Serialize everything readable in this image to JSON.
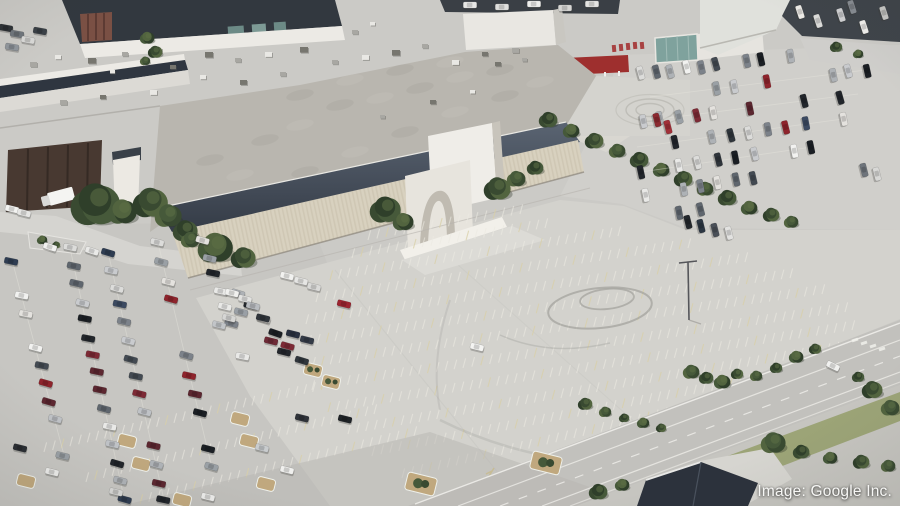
{
  "caption": {
    "text": "Image: Google Inc."
  },
  "palette": {
    "base": "#cbcac6",
    "lot": "#d3d2cd",
    "parkingLeft": "#c7c6c2",
    "parkingRight": "#d0cfcb",
    "road": "#c2c1bd",
    "roadShade": "#b7b6b2",
    "verge": "#c6c5c0",
    "roofLight": "#c6c4bf",
    "roofGravel": "#b9b6af",
    "roofDark1": "#5a6472",
    "roofDark2": "#343b46",
    "roofNavy": "#32383f",
    "facade": "#d8d1bf",
    "white": "#eceae5",
    "brick": "#7a5044",
    "dock": "#483931",
    "teal": "#7fa29d",
    "redCanopy": "#9e2f2e",
    "grass": "#97a06f",
    "mulch": "#c0a87e",
    "treeDark": "#394a31",
    "treeMid": "#46593a",
    "treeLight": "#5d7045",
    "stripe": "#eceae2",
    "stripeYellow": "#d9d0a8",
    "navyRoofBldg": "#2c323c"
  },
  "scene": {
    "car_colors": [
      "#e9e9e7",
      "#f2f2f0",
      "#dcdcda",
      "#c9cbce",
      "#aeb2b6",
      "#9aa0a5",
      "#7c828a",
      "#5f666e",
      "#434a52",
      "#2f353b",
      "#22262b",
      "#1b1f24",
      "#8e242c",
      "#7d2a35",
      "#5c2730",
      "#3c4a61",
      "#2f3d52",
      "#d9d7d2",
      "#bfc2c6",
      "#e4e2de"
    ],
    "left_rows": [
      {
        "x1": 12,
        "y1": 260,
        "x2": 64,
        "y2": 455,
        "n": 12,
        "d": 0.82,
        "rot": 14,
        "line": true
      },
      {
        "x1": 70,
        "y1": 248,
        "x2": 124,
        "y2": 498,
        "n": 15,
        "d": 0.9,
        "rot": 14,
        "line": true
      },
      {
        "x1": 108,
        "y1": 252,
        "x2": 164,
        "y2": 500,
        "n": 15,
        "d": 0.88,
        "rot": 14,
        "line": true
      },
      {
        "x1": 158,
        "y1": 243,
        "x2": 212,
        "y2": 468,
        "n": 13,
        "d": 0.78,
        "rot": 14,
        "line": true
      },
      {
        "x1": 203,
        "y1": 241,
        "x2": 242,
        "y2": 356,
        "n": 8,
        "d": 0.8,
        "rot": 14
      },
      {
        "x1": 237,
        "y1": 292,
        "x2": 302,
        "y2": 360,
        "n": 6,
        "d": 0.85,
        "rot": 16
      }
    ],
    "right_rows": [
      {
        "x1": 642,
        "y1": 74,
        "x2": 790,
        "y2": 55,
        "n": 11,
        "d": 0.85,
        "rot": 77
      },
      {
        "x1": 650,
        "y1": 97,
        "x2": 866,
        "y2": 70,
        "n": 14,
        "d": 0.62,
        "rot": 77,
        "line": true
      },
      {
        "x1": 643,
        "y1": 121,
        "x2": 858,
        "y2": 94,
        "n": 13,
        "d": 0.68,
        "rot": 77,
        "line": true
      },
      {
        "x1": 637,
        "y1": 147,
        "x2": 843,
        "y2": 119,
        "n": 12,
        "d": 0.66,
        "rot": 77,
        "line": true
      },
      {
        "x1": 641,
        "y1": 172,
        "x2": 812,
        "y2": 147,
        "n": 10,
        "d": 0.58,
        "rot": 77,
        "line": true
      },
      {
        "x1": 647,
        "y1": 196,
        "x2": 772,
        "y2": 174,
        "n": 8,
        "d": 0.6,
        "rot": 77
      },
      {
        "x1": 660,
        "y1": 215,
        "x2": 742,
        "y2": 202,
        "n": 5,
        "d": 0.5,
        "rot": 77
      }
    ],
    "extra_cars": [
      [
        6,
        28,
        10,
        "#2e3236"
      ],
      [
        17,
        34,
        10,
        "#70767c"
      ],
      [
        28,
        40,
        10,
        "#d9d9d7"
      ],
      [
        40,
        31,
        10,
        "#3a4046"
      ],
      [
        12,
        47,
        10,
        "#90969c"
      ],
      [
        800,
        12,
        72,
        "#eceae6"
      ],
      [
        818,
        21,
        72,
        "#dcdcda"
      ],
      [
        841,
        15,
        72,
        "#cfd0d2"
      ],
      [
        864,
        27,
        72,
        "#f0efec"
      ],
      [
        884,
        13,
        72,
        "#c7c7c5"
      ],
      [
        852,
        7,
        72,
        "#878c92"
      ],
      [
        470,
        5,
        0,
        "#e8e8e6"
      ],
      [
        502,
        7,
        0,
        "#dfdfdd"
      ],
      [
        534,
        4,
        0,
        "#eeeeec"
      ],
      [
        565,
        8,
        0,
        "#d6d6d4"
      ],
      [
        592,
        4,
        0,
        "#e4e4e2"
      ],
      [
        50,
        247,
        18,
        "#f1f1ef"
      ],
      [
        92,
        251,
        18,
        "#e9e9e7"
      ],
      [
        12,
        209,
        14,
        "#f3f3f1"
      ],
      [
        24,
        213,
        14,
        "#e6e6e4"
      ],
      [
        477,
        347,
        14,
        "#f4f4f2"
      ],
      [
        688,
        222,
        76,
        "#23272c"
      ],
      [
        701,
        226,
        76,
        "#2c3642"
      ],
      [
        715,
        230,
        76,
        "#4a5058"
      ],
      [
        729,
        233,
        76,
        "#e2e2e0"
      ],
      [
        345,
        419,
        14,
        "#1f2327"
      ],
      [
        833,
        366,
        26,
        "#f1f1ef"
      ],
      [
        864,
        170,
        76,
        "#6e747b"
      ],
      [
        877,
        174,
        76,
        "#d8d8d6"
      ],
      [
        657,
        120,
        76,
        "#8c2a30"
      ],
      [
        668,
        127,
        76,
        "#a13038"
      ],
      [
        287,
        276,
        14,
        "#f2f2f0"
      ],
      [
        301,
        281,
        14,
        "#e6e6e4"
      ],
      [
        314,
        287,
        14,
        "#dadad8"
      ],
      [
        293,
        334,
        14,
        "#2a3140"
      ],
      [
        307,
        340,
        14,
        "#333a46"
      ],
      [
        271,
        341,
        14,
        "#6e2a36"
      ],
      [
        284,
        352,
        14,
        "#23262b"
      ],
      [
        344,
        304,
        14,
        "#9c2430"
      ],
      [
        232,
        293,
        14,
        "#f0f0ee"
      ],
      [
        245,
        299,
        14,
        "#e2e2e0"
      ],
      [
        253,
        306,
        14,
        "#b9bcc0"
      ],
      [
        241,
        312,
        14,
        "#9aa0a6"
      ],
      [
        229,
        318,
        14,
        "#d6d6d4"
      ],
      [
        219,
        325,
        14,
        "#c2c5c8"
      ],
      [
        263,
        318,
        14,
        "#30353b"
      ],
      [
        52,
        472,
        14,
        "#ececea"
      ],
      [
        20,
        448,
        14,
        "#2a2e33"
      ],
      [
        116,
        492,
        14,
        "#d8d8d6"
      ],
      [
        208,
        497,
        14,
        "#eaeae8"
      ],
      [
        262,
        448,
        14,
        "#c9ccce"
      ],
      [
        287,
        470,
        14,
        "#f0f0ee"
      ],
      [
        302,
        418,
        14,
        "#2f3339"
      ]
    ],
    "lot_stripe_rows": [
      {
        "x1": 368,
        "y1": 240,
        "x2": 520,
        "y2": 214,
        "n": 17
      },
      {
        "x1": 352,
        "y1": 258,
        "x2": 545,
        "y2": 228,
        "n": 22
      },
      {
        "x1": 330,
        "y1": 280,
        "x2": 618,
        "y2": 236,
        "n": 33
      },
      {
        "x1": 316,
        "y1": 302,
        "x2": 688,
        "y2": 248,
        "n": 42
      },
      {
        "x1": 306,
        "y1": 324,
        "x2": 745,
        "y2": 262,
        "n": 50
      },
      {
        "x1": 300,
        "y1": 346,
        "x2": 790,
        "y2": 278,
        "n": 56
      },
      {
        "x1": 304,
        "y1": 368,
        "x2": 822,
        "y2": 294,
        "n": 59
      },
      {
        "x1": 312,
        "y1": 390,
        "x2": 845,
        "y2": 312,
        "n": 60
      },
      {
        "x1": 328,
        "y1": 412,
        "x2": 852,
        "y2": 330,
        "n": 59
      },
      {
        "x1": 348,
        "y1": 434,
        "x2": 845,
        "y2": 350,
        "n": 56
      },
      {
        "x1": 372,
        "y1": 456,
        "x2": 810,
        "y2": 372,
        "n": 49
      },
      {
        "x1": 402,
        "y1": 478,
        "x2": 755,
        "y2": 396,
        "n": 39
      },
      {
        "x1": 44,
        "y1": 452,
        "x2": 330,
        "y2": 388,
        "n": 33
      },
      {
        "x1": 86,
        "y1": 482,
        "x2": 374,
        "y2": 414,
        "n": 33
      },
      {
        "x1": 140,
        "y1": 504,
        "x2": 414,
        "y2": 436,
        "n": 31
      }
    ],
    "stripe_tick": [
      2.6,
      -9.6
    ],
    "trees": [
      [
        95,
        205,
        24
      ],
      [
        122,
        212,
        14
      ],
      [
        150,
        203,
        17
      ],
      [
        168,
        216,
        13
      ],
      [
        185,
        231,
        12
      ],
      [
        215,
        248,
        17
      ],
      [
        243,
        258,
        12
      ],
      [
        190,
        240,
        9
      ],
      [
        385,
        210,
        15
      ],
      [
        403,
        222,
        10
      ],
      [
        497,
        189,
        13
      ],
      [
        516,
        179,
        9
      ],
      [
        535,
        168,
        8
      ],
      [
        147,
        38,
        7
      ],
      [
        155,
        52,
        7
      ],
      [
        145,
        61,
        5
      ],
      [
        548,
        120,
        9
      ],
      [
        571,
        131,
        8
      ],
      [
        594,
        141,
        9
      ],
      [
        617,
        151,
        8
      ],
      [
        639,
        160,
        9
      ],
      [
        661,
        170,
        8
      ],
      [
        683,
        179,
        9
      ],
      [
        705,
        189,
        8
      ],
      [
        727,
        198,
        9
      ],
      [
        749,
        208,
        8
      ],
      [
        771,
        215,
        8
      ],
      [
        791,
        222,
        7
      ],
      [
        836,
        47,
        6
      ],
      [
        858,
        54,
        5
      ],
      [
        585,
        404,
        7
      ],
      [
        605,
        412,
        6
      ],
      [
        624,
        418,
        5
      ],
      [
        643,
        423,
        6
      ],
      [
        661,
        428,
        5
      ],
      [
        691,
        372,
        8
      ],
      [
        706,
        378,
        7
      ],
      [
        722,
        382,
        8
      ],
      [
        737,
        374,
        6
      ],
      [
        756,
        376,
        6
      ],
      [
        776,
        368,
        6
      ],
      [
        796,
        357,
        7
      ],
      [
        815,
        349,
        6
      ],
      [
        773,
        443,
        12
      ],
      [
        801,
        452,
        8
      ],
      [
        830,
        458,
        7
      ],
      [
        861,
        462,
        8
      ],
      [
        888,
        466,
        7
      ],
      [
        598,
        492,
        9
      ],
      [
        622,
        485,
        7
      ],
      [
        872,
        390,
        10
      ],
      [
        890,
        408,
        9
      ],
      [
        858,
        377,
        6
      ],
      [
        42,
        240,
        5
      ],
      [
        56,
        245,
        4
      ]
    ],
    "islands": [
      [
        127,
        441,
        0
      ],
      [
        141,
        464,
        0
      ],
      [
        240,
        419,
        0
      ],
      [
        249,
        441,
        0
      ],
      [
        26,
        481,
        0
      ],
      [
        266,
        484,
        0
      ],
      [
        182,
        500,
        0
      ],
      [
        313,
        370,
        1
      ],
      [
        331,
        382,
        1
      ],
      [
        421,
        484,
        2
      ],
      [
        546,
        463,
        2
      ]
    ],
    "hvac": [
      [
        30,
        62,
        7
      ],
      [
        55,
        55,
        6
      ],
      [
        88,
        58,
        8
      ],
      [
        122,
        52,
        6
      ],
      [
        155,
        48,
        7
      ],
      [
        205,
        52,
        8
      ],
      [
        235,
        58,
        6
      ],
      [
        265,
        52,
        7
      ],
      [
        300,
        47,
        8
      ],
      [
        332,
        60,
        6
      ],
      [
        362,
        55,
        7
      ],
      [
        392,
        50,
        8
      ],
      [
        422,
        44,
        6
      ],
      [
        452,
        60,
        7
      ],
      [
        482,
        52,
        6
      ],
      [
        512,
        48,
        7
      ],
      [
        200,
        75,
        6
      ],
      [
        240,
        80,
        7
      ],
      [
        280,
        72,
        6
      ],
      [
        150,
        90,
        7
      ],
      [
        100,
        95,
        6
      ],
      [
        60,
        100,
        7
      ],
      [
        110,
        70,
        5
      ],
      [
        170,
        65,
        6
      ],
      [
        352,
        30,
        6
      ],
      [
        370,
        22,
        5
      ],
      [
        495,
        62,
        6
      ],
      [
        522,
        58,
        5
      ],
      [
        470,
        90,
        5
      ],
      [
        430,
        100,
        6
      ],
      [
        380,
        115,
        5
      ]
    ],
    "mottle": [
      [
        210,
        160
      ],
      [
        240,
        175
      ],
      [
        265,
        140
      ],
      [
        300,
        125
      ],
      [
        340,
        105
      ],
      [
        380,
        98
      ],
      [
        420,
        88
      ],
      [
        460,
        77
      ],
      [
        500,
        70
      ],
      [
        255,
        192
      ],
      [
        305,
        172
      ],
      [
        355,
        152
      ],
      [
        405,
        132
      ],
      [
        455,
        112
      ],
      [
        505,
        96
      ],
      [
        540,
        82
      ],
      [
        300,
        95
      ],
      [
        350,
        80
      ],
      [
        400,
        70
      ],
      [
        450,
        62
      ]
    ]
  }
}
